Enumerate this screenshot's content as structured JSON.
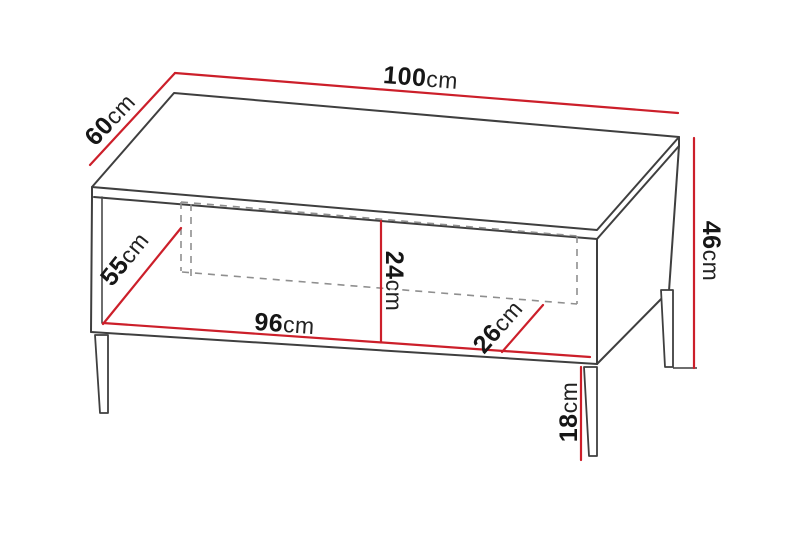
{
  "diagram": {
    "type": "furniture-dimension-drawing",
    "subject": "coffee table with open niche, hidden drawer outline and metal legs",
    "unit": "cm",
    "dimensions": {
      "top_width": {
        "value": "100",
        "unit": "cm",
        "description": "overall width of table top"
      },
      "top_depth": {
        "value": "60",
        "unit": "cm",
        "description": "overall depth of table top"
      },
      "overall_height": {
        "value": "46",
        "unit": "cm",
        "description": "overall height"
      },
      "inner_left_depth": {
        "value": "55",
        "unit": "cm",
        "description": "inner diagonal depth, left compartment"
      },
      "inner_height": {
        "value": "24",
        "unit": "cm",
        "description": "inner niche height"
      },
      "inner_width": {
        "value": "96",
        "unit": "cm",
        "description": "inner niche width"
      },
      "inner_right_depth": {
        "value": "26",
        "unit": "cm",
        "description": "inner diagonal depth, right compartment"
      },
      "leg_height": {
        "value": "18",
        "unit": "cm",
        "description": "leg height"
      }
    }
  },
  "colors": {
    "dimension_line": "#cc1f2a",
    "outline": "#3f3f3f",
    "hidden_line": "#8f8f8f",
    "text": "#161616",
    "background": "#ffffff"
  }
}
